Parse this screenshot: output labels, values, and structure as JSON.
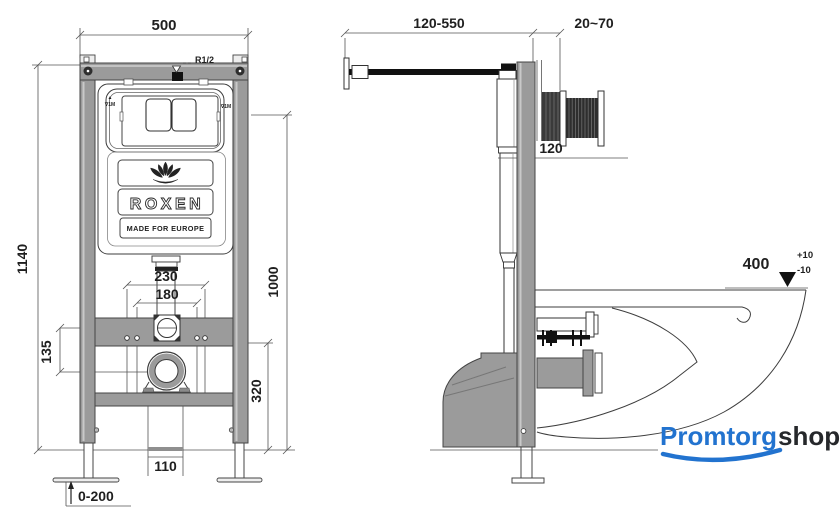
{
  "drawing": {
    "front_view": {
      "dim_frame_width": "500",
      "dim_frame_height": "1140",
      "dim_button_height": "1000",
      "dim_fixing_outer": "230",
      "dim_fixing_inner": "180",
      "dim_drain_offset": "135",
      "dim_drain_height": "320",
      "dim_floor_outlet_width": "110",
      "dim_leg_adjust": "0-200",
      "inlet_thread_label": "R1/2",
      "mark_left_arrow": "▲",
      "mark_left": "∇1M",
      "mark_right": "∇1M",
      "brand_name": "ROXEN",
      "brand_tagline": "MADE FOR EUROPE",
      "brand_icon": "lotus-icon"
    },
    "side_view": {
      "dim_inlet_reach": "120-550",
      "dim_wall_thickness": "20~70",
      "dim_frame_depth": "120",
      "dim_bowl_height": "400",
      "dim_bowl_tol_plus": "+10",
      "dim_bowl_tol_minus": "-10"
    },
    "watermark": {
      "name_primary": "Promtorg",
      "name_secondary": "shop"
    },
    "colors": {
      "frame_gray": "#9b9b9b",
      "line_dark": "#3d3d3d",
      "dim_text": "#1f1f1f",
      "logo_blue": "#2273cf",
      "logo_dark": "#26282b"
    }
  }
}
